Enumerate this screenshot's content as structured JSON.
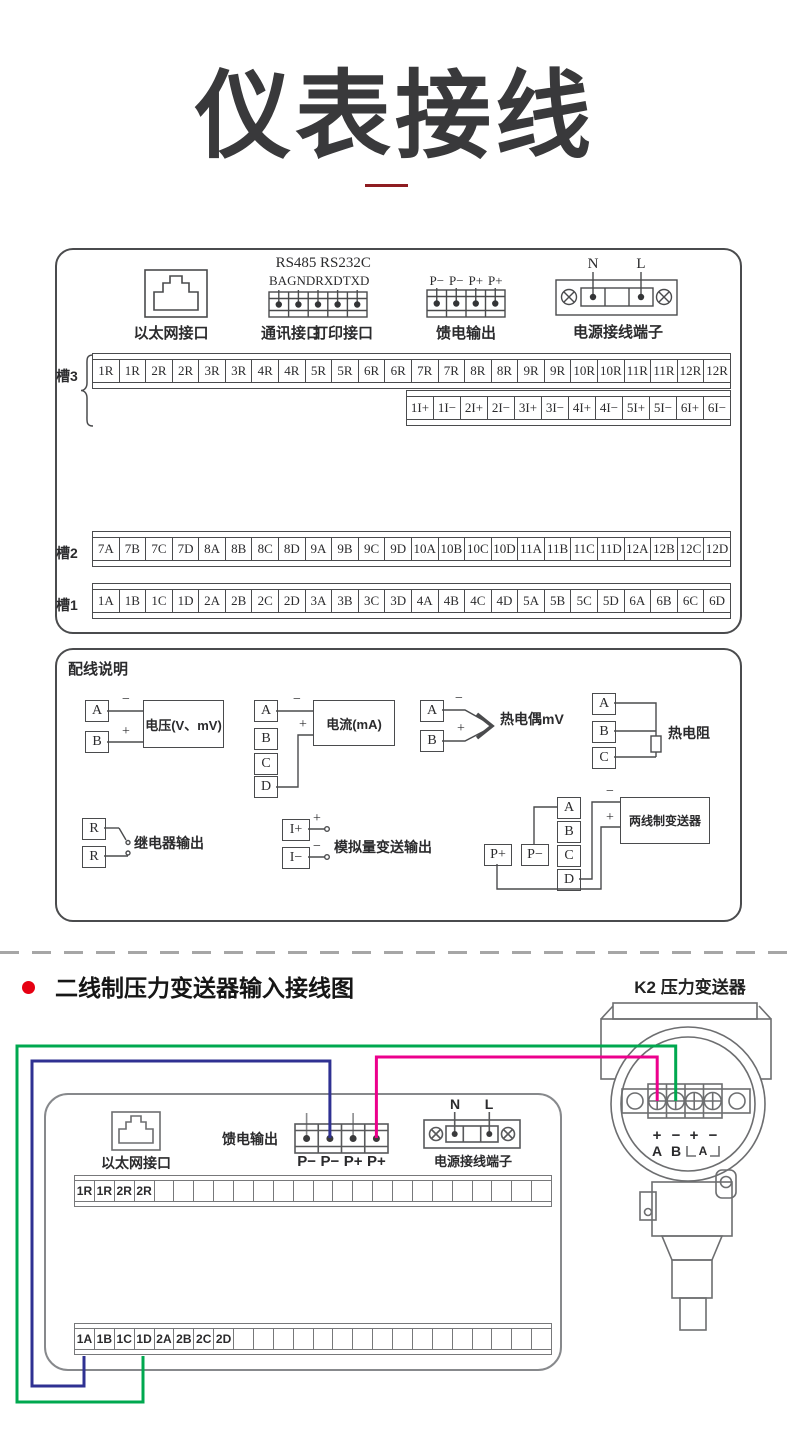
{
  "title": {
    "text": "仪表接线"
  },
  "section2": {
    "bullet_title": "二线制压力变送器输入接线图"
  },
  "colors": {
    "accent_red": "#e60012",
    "underline_red": "#8e1c21",
    "line_gray": "#4a4b4d",
    "wire_green": "#00a84f",
    "wire_blue": "#2f3192",
    "wire_magenta": "#ec008c"
  },
  "main_panel": {
    "ethernet_label": "以太网接口",
    "comm": {
      "rs485": "RS485",
      "rs232c": "RS232C",
      "pins": [
        "B",
        "A",
        "GND",
        "RXD",
        "TXD"
      ],
      "label_comm": "通讯接口",
      "label_print": "打印接口"
    },
    "feed": {
      "pins": [
        "P−",
        "P−",
        "P+",
        "P+"
      ],
      "label": "馈电输出"
    },
    "power": {
      "n": "N",
      "l": "L",
      "label": "电源接线端子"
    },
    "slot3": {
      "label": "槽3",
      "row_r": [
        "1R",
        "1R",
        "2R",
        "2R",
        "3R",
        "3R",
        "4R",
        "4R",
        "5R",
        "5R",
        "6R",
        "6R",
        "7R",
        "7R",
        "8R",
        "8R",
        "9R",
        "9R",
        "10R",
        "10R",
        "11R",
        "11R",
        "12R",
        "12R"
      ],
      "row_i": [
        "1I+",
        "1I−",
        "2I+",
        "2I−",
        "3I+",
        "3I−",
        "4I+",
        "4I−",
        "5I+",
        "5I−",
        "6I+",
        "6I−"
      ]
    },
    "slot2": {
      "label": "槽2",
      "row": [
        "7A",
        "7B",
        "7C",
        "7D",
        "8A",
        "8B",
        "8C",
        "8D",
        "9A",
        "9B",
        "9C",
        "9D",
        "10A",
        "10B",
        "10C",
        "10D",
        "11A",
        "11B",
        "11C",
        "11D",
        "12A",
        "12B",
        "12C",
        "12D"
      ]
    },
    "slot1": {
      "label": "槽1",
      "row": [
        "1A",
        "1B",
        "1C",
        "1D",
        "2A",
        "2B",
        "2C",
        "2D",
        "3A",
        "3B",
        "3C",
        "3D",
        "4A",
        "4B",
        "4C",
        "4D",
        "5A",
        "5B",
        "5C",
        "5D",
        "6A",
        "6B",
        "6C",
        "6D"
      ]
    }
  },
  "wiring_panel": {
    "title": "配线说明",
    "voltage": {
      "a": "A",
      "b": "B",
      "minus": "−",
      "plus": "+",
      "label": "电压(V、mV)"
    },
    "current": {
      "a": "A",
      "b": "B",
      "c": "C",
      "d": "D",
      "minus": "−",
      "plus": "+",
      "label": "电流(mA)"
    },
    "thermocouple": {
      "a": "A",
      "b": "B",
      "minus": "−",
      "plus": "+",
      "label": "热电偶mV"
    },
    "rtd": {
      "a": "A",
      "b": "B",
      "c": "C",
      "label": "热电阻"
    },
    "relay": {
      "r1": "R",
      "r2": "R",
      "label": "继电器输出"
    },
    "analog": {
      "ip": "I+",
      "im": "I−",
      "plus": "+",
      "minus": "−",
      "label": "模拟量变送输出"
    },
    "two_wire": {
      "pp": "P+",
      "pm": "P−",
      "a": "A",
      "b": "B",
      "c": "C",
      "d": "D",
      "minus": "−",
      "plus": "+",
      "label": "两线制变送器"
    }
  },
  "bottom_panel": {
    "ethernet_label": "以太网接口",
    "feed_label": "馈电输出",
    "feed_pins": [
      "P−",
      "P−",
      "P+",
      "P+"
    ],
    "power": {
      "n": "N",
      "l": "L",
      "label": "电源接线端子"
    },
    "row_r": [
      "1R",
      "1R",
      "2R",
      "2R",
      "",
      "",
      "",
      "",
      "",
      "",
      "",
      "",
      "",
      "",
      "",
      "",
      "",
      "",
      "",
      "",
      "",
      "",
      "",
      ""
    ],
    "row_a": [
      "1A",
      "1B",
      "1C",
      "1D",
      "2A",
      "2B",
      "2C",
      "2D",
      "",
      "",
      "",
      "",
      "",
      "",
      "",
      "",
      "",
      "",
      "",
      "",
      "",
      "",
      "",
      ""
    ]
  },
  "transmitter": {
    "title": "K2 压力变送器",
    "signs": [
      "+",
      "−",
      "+",
      "−"
    ],
    "letters": [
      "A",
      "B"
    ],
    "ammeter": "A"
  }
}
